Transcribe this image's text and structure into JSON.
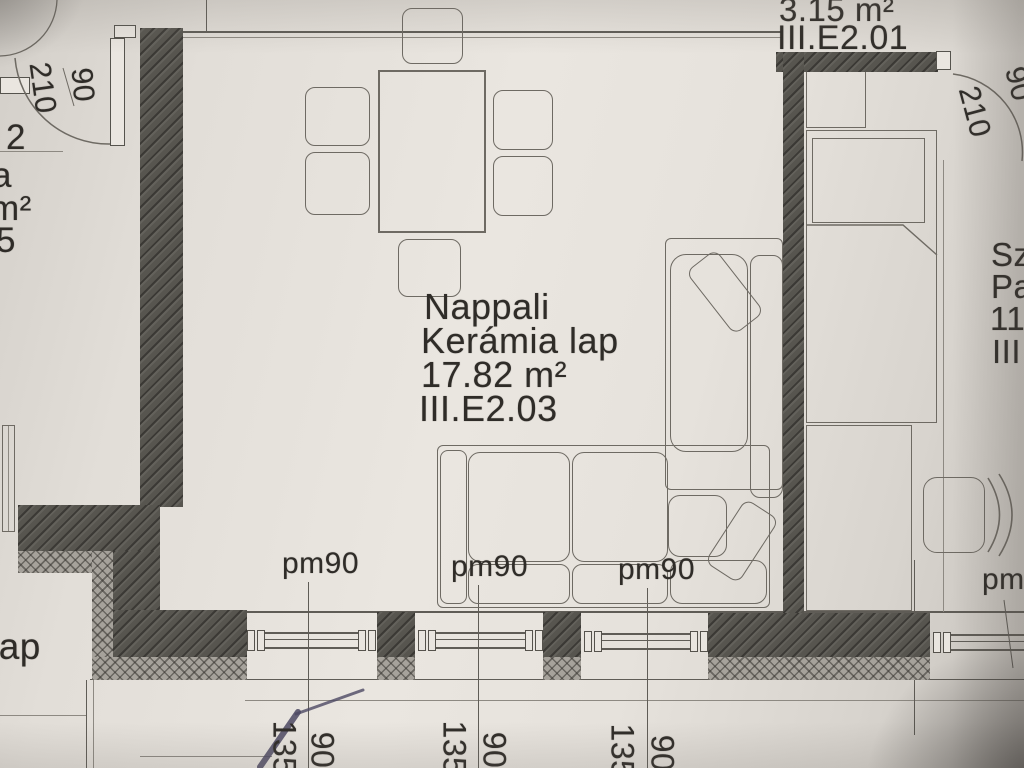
{
  "rooms": {
    "hall": {
      "area": "3.15 m²",
      "id": "III.E2.01"
    },
    "living": {
      "name": "Nappali",
      "floor": "Kerámia lap",
      "area": "17.82 m²",
      "id": "III.E2.03"
    }
  },
  "fragments": {
    "left": [
      "2",
      "a",
      "m²",
      "5"
    ],
    "right": [
      "Sz",
      "Pa",
      "11",
      "III"
    ],
    "bottom_left": "lap",
    "bottom_right": "pm"
  },
  "doors": {
    "left": {
      "width": "90",
      "height": "210"
    },
    "right": {
      "width": "90",
      "height": "210"
    }
  },
  "parapet_labels": [
    "pm90",
    "pm90",
    "pm90"
  ],
  "window_dims": [
    {
      "width": "135",
      "pier": "90"
    },
    {
      "width": "135",
      "pier": "90"
    },
    {
      "width": "135",
      "pier": "90"
    }
  ]
}
